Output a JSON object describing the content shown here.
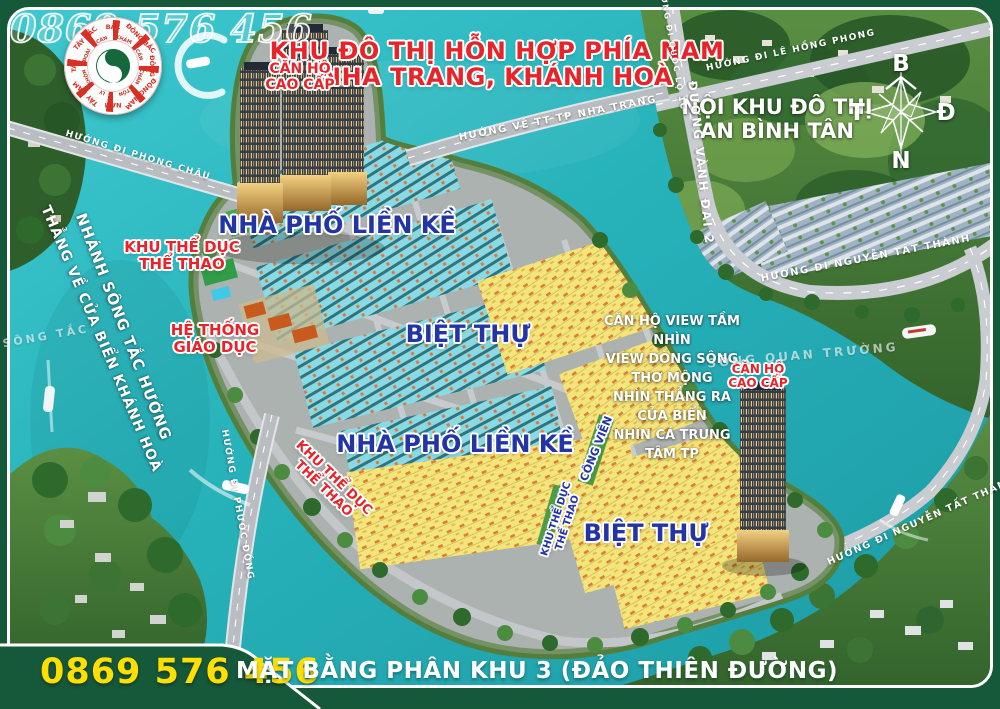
{
  "watermark_phone": "0869 576 456",
  "header": {
    "title_line1": "KHU ĐÔ THỊ HỖN HỢP PHÍA NAM",
    "title_line2": "NHA TRANG, KHÁNH HOÀ"
  },
  "compass": {
    "north": "B",
    "east": "Đ",
    "south": "N",
    "west": "T"
  },
  "fengshui": {
    "directions": [
      "BẮC",
      "ĐÔNG BẮC",
      "ĐÔNG",
      "ĐÔNG NAM",
      "NAM",
      "TÂY NAM",
      "TÂY",
      "TÂY BẮC"
    ],
    "trigrams": [
      "KHẢM",
      "CẤN",
      "CHẤN",
      "TỐN",
      "LY",
      "KHÔN",
      "ĐOÀI",
      "CÀN"
    ]
  },
  "districts": {
    "an_binh_tan": {
      "line1": "NỘI KHU ĐÔ THỊ",
      "line2": "AN BÌNH TÂN"
    },
    "apartment_north": {
      "line1": "CĂN HỘ",
      "line2": "CAO CẤP"
    },
    "apartment_south": {
      "line1": "CĂN HỘ",
      "line2": "CAO CẤP"
    },
    "townhouse_north": "NHÀ  PHỐ LIỀN KỀ",
    "townhouse_south": "NHÀ  PHỐ LIỀN KỀ",
    "villa_east": "BIỆT THỰ",
    "villa_south": "BIỆT THỰ",
    "sports_north": {
      "line1": "KHU THỂ DỤC",
      "line2": "THỂ THAO"
    },
    "sports_west": {
      "line1": "KHU THỂ DỤC",
      "line2": "THỂ THAO"
    },
    "sports_mid": {
      "line1": "KHU THỂ DỤC",
      "line2": "THỂ THAO"
    },
    "education": {
      "line1": "HỆ THỐNG",
      "line2": "GIÁO DỤC"
    },
    "park": "CÔNG VIÊN"
  },
  "callout": {
    "line1": "CĂN HỘ VIEW TẦM NHÌN",
    "line2": "VIEW DÒNG SÔNG THƠ MỘNG",
    "line3": "NHÌN THẲNG RA CỬA BIỂN",
    "line4": "NHÌN CẢ TRUNG TÂM TP"
  },
  "rivers": {
    "song_tac": "SÔNG TẮC",
    "song_quan_truong": "SÔNG QUAN TRƯỜNG",
    "branch_line1": "NHÁNH SÔNG TẮC HƯỚNG",
    "branch_line2": "THẲNG VỀ CỬA BIỂN KHÁNH HOÀ"
  },
  "roads": {
    "phong_chau": "HƯỚNG ĐI PHONG CHÂU",
    "tt_nha_trang": "HƯỚNG VỀ TT TP NHA TRANG",
    "quoc_lo_1c": "HƯỚNG ĐI QUỐC LỘ 1C",
    "le_hong_phong": "HƯỚNG ĐI LÊ HỒNG PHONG",
    "vanh_dai_2": "ĐƯỜNG VÀNH ĐAI 2",
    "nguyen_tat_thanh_ne": "HƯỚNG ĐI NGUYỄN TẤT THÀNH",
    "nguyen_tat_thanh_se": "HƯỚNG ĐI NGUYỄN TẤT THÀNH",
    "phuoc_dong": "HƯỚNG ĐI PHƯỚC ĐỒNG"
  },
  "footer": {
    "phone": "0869 576 456",
    "plan_title": "MẶT BẰNG PHÂN KHU 3 (ĐẢO THIÊN ĐƯỜNG)"
  },
  "colors": {
    "water": "#28b6bd",
    "frame_green": "#16583a",
    "accent_red": "#e8232a",
    "accent_blue": "#2334a5",
    "phone_yellow": "#ffdf00"
  }
}
